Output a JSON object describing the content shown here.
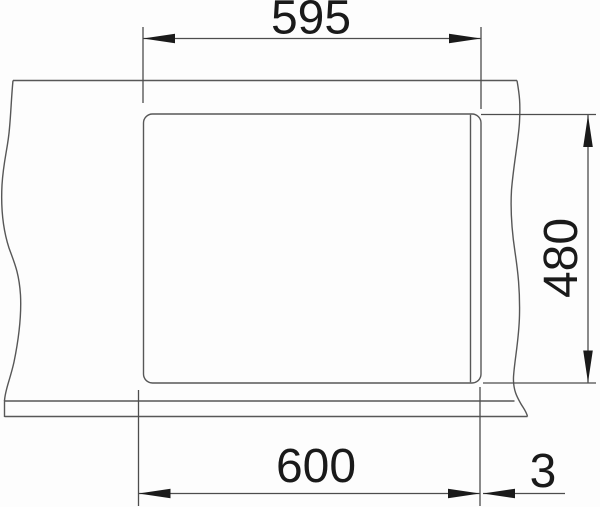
{
  "drawing": {
    "background_color": "#fdfdfd",
    "line_color": "#575757",
    "ink_color": "#1a1a1a",
    "labels": {
      "top_width": "595",
      "side_depth": "480",
      "bottom_width": "600",
      "edge_gap": "3"
    }
  }
}
